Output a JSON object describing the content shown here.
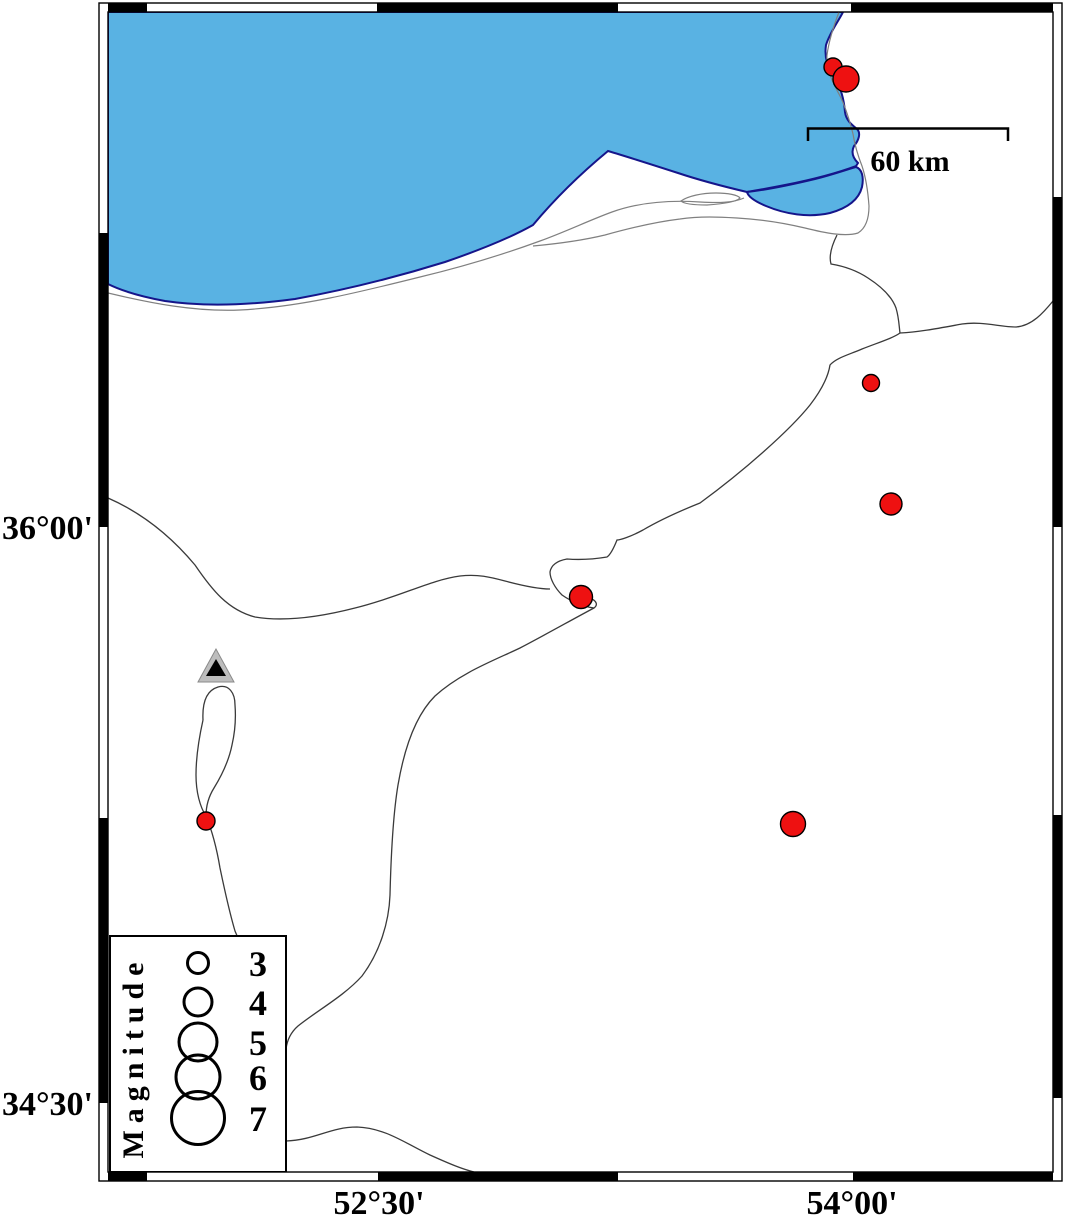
{
  "map": {
    "type": "seismicity-map",
    "frame": {
      "left_axis": [
        {
          "label": "36°00'"
        },
        {
          "label": "34°30'"
        }
      ],
      "bottom_axis": [
        {
          "label": "52°30'"
        },
        {
          "label": "54°00'"
        }
      ]
    },
    "scalebar": {
      "label": "60 km",
      "length_km": 60
    },
    "legend": {
      "title": "Magnitude",
      "entries": [
        {
          "magnitude": "3",
          "radius": 10.5
        },
        {
          "magnitude": "4",
          "radius": 14
        },
        {
          "magnitude": "5",
          "radius": 19
        },
        {
          "magnitude": "6",
          "radius": 22
        },
        {
          "magnitude": "7",
          "radius": 26.5
        }
      ]
    },
    "earthquakes": [
      {
        "x": 833,
        "y": 67,
        "r": 9
      },
      {
        "x": 846,
        "y": 79,
        "r": 13
      },
      {
        "x": 871,
        "y": 383,
        "r": 8.5
      },
      {
        "x": 891,
        "y": 504,
        "r": 11
      },
      {
        "x": 581,
        "y": 597,
        "r": 11.5
      },
      {
        "x": 206,
        "y": 821,
        "r": 9
      },
      {
        "x": 793,
        "y": 824,
        "r": 12.5
      }
    ],
    "station": {
      "x": 216,
      "y": 667
    },
    "colors": {
      "sea": "#59B2E3",
      "coast_outline": "#15158A",
      "land": "#FFFFFF",
      "event_fill": "#EE1111",
      "event_stroke": "#000000",
      "road": "#3a3a3a",
      "shore_line": "#808080",
      "frame": "#000000",
      "station_outer": "#BDBDBD",
      "station_inner": "#000000"
    }
  }
}
